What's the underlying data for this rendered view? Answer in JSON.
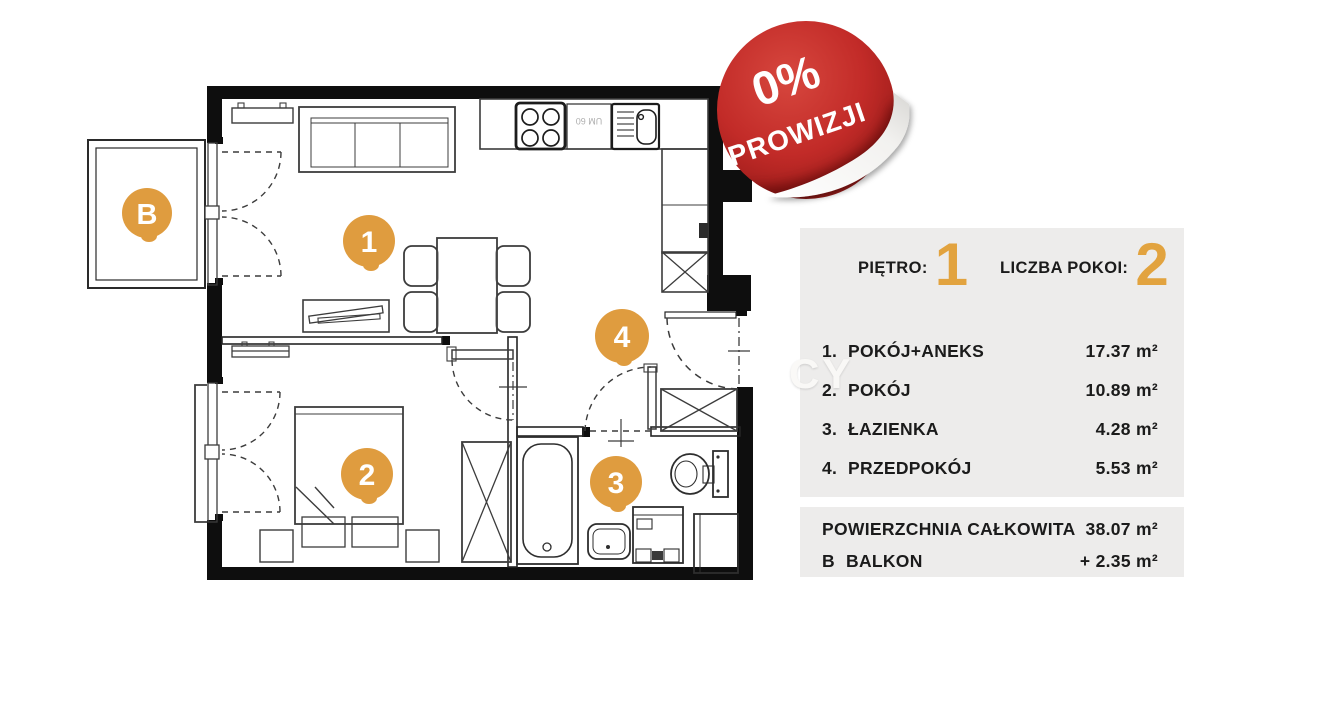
{
  "badge": {
    "top_line": "0%",
    "bottom_line": "PROWIZJI",
    "color": "#C1272D"
  },
  "watermark": {
    "text": "CY"
  },
  "floorplan": {
    "markers": [
      {
        "label": "B",
        "meaning": "balkon"
      },
      {
        "label": "1",
        "meaning": "pokój+aneks"
      },
      {
        "label": "2",
        "meaning": "pokój"
      },
      {
        "label": "3",
        "meaning": "łazienka"
      },
      {
        "label": "4",
        "meaning": "przedpokój"
      }
    ],
    "kitchen_unit_label": "UM 60",
    "marker_color": "#DF9C3F"
  },
  "panel": {
    "background": "#EDECEB",
    "floor_label": "PIĘTRO:",
    "floor_value": "1",
    "rooms_label": "LICZBA POKOI:",
    "rooms_value": "2",
    "rows": [
      {
        "num": "1.",
        "name": "POKÓJ+ANEKS",
        "area": "17.37 m²"
      },
      {
        "num": "2.",
        "name": "POKÓJ",
        "area": "10.89 m²"
      },
      {
        "num": "3.",
        "name": "ŁAZIENKA",
        "area": "4.28 m²"
      },
      {
        "num": "4.",
        "name": "PRZEDPOKÓJ",
        "area": "5.53 m²"
      }
    ],
    "totals": [
      {
        "num": "",
        "name": "POWIERZCHNIA CAŁKOWITA",
        "area": "38.07 m²"
      },
      {
        "num": "B",
        "name": "BALKON",
        "area": "+ 2.35 m²"
      }
    ],
    "digit_color": "#E2A33F"
  }
}
